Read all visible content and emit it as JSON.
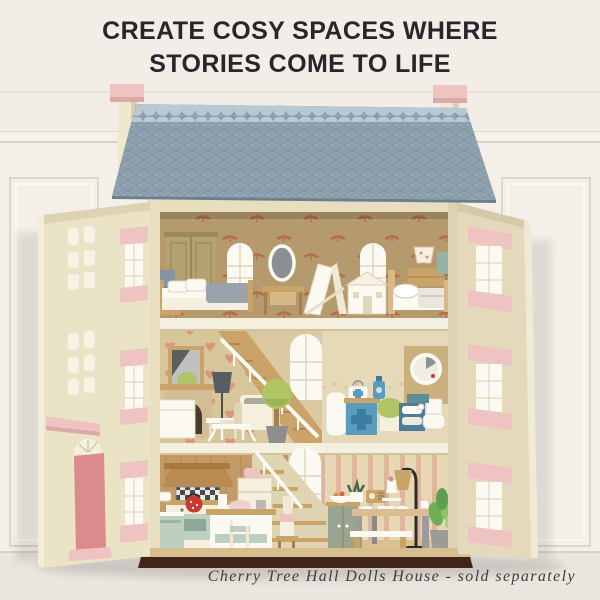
{
  "heading": {
    "line1": "CREATE COSY SPACES WHERE",
    "line2": "STORIES COME TO LIFE"
  },
  "caption": {
    "text": "Cherry Tree Hall Dolls House - sold separately"
  },
  "product": {
    "name": "Cherry Tree Hall Dolls House",
    "availability_note": "sold separately"
  },
  "palette": {
    "background": "#f2ede6",
    "wall_white": "#f6f2eb",
    "panel_line": "#ded6c8",
    "floor": "#ebe5df",
    "headline": "#26272b",
    "caption": "#3f3d3a",
    "roof": "#8fa1ae",
    "roof_trim": "#b9c9d4",
    "roof_line": "#76899a",
    "pink": "#eec3c2",
    "pink_dark": "#d98b8d",
    "cream": "#e7debf",
    "cream_light": "#f4efde",
    "cream_mid": "#dfd5b2",
    "wood": "#c9a368",
    "wood_dark": "#a87e4e",
    "wallpaper_top": "#b49a6c",
    "motif": "#b5654a",
    "hearts_bg": "#d8c69b",
    "heart": "#d9937b",
    "bath_bg": "#e5d9b8",
    "stripe_bg": "#e7d7b4",
    "stripe": "#d79a8c",
    "plank": "#c49a66",
    "base_dark": "#42251a",
    "blue": "#5b9cbc",
    "blue_deep": "#3e7ca3",
    "teal": "#5f8d96",
    "mint": "#bccfc0",
    "green": "#aec465",
    "grey": "#9b9b99",
    "white_warm": "#fbf9f2",
    "olive": "#b2a171",
    "red": "#c93a32"
  }
}
